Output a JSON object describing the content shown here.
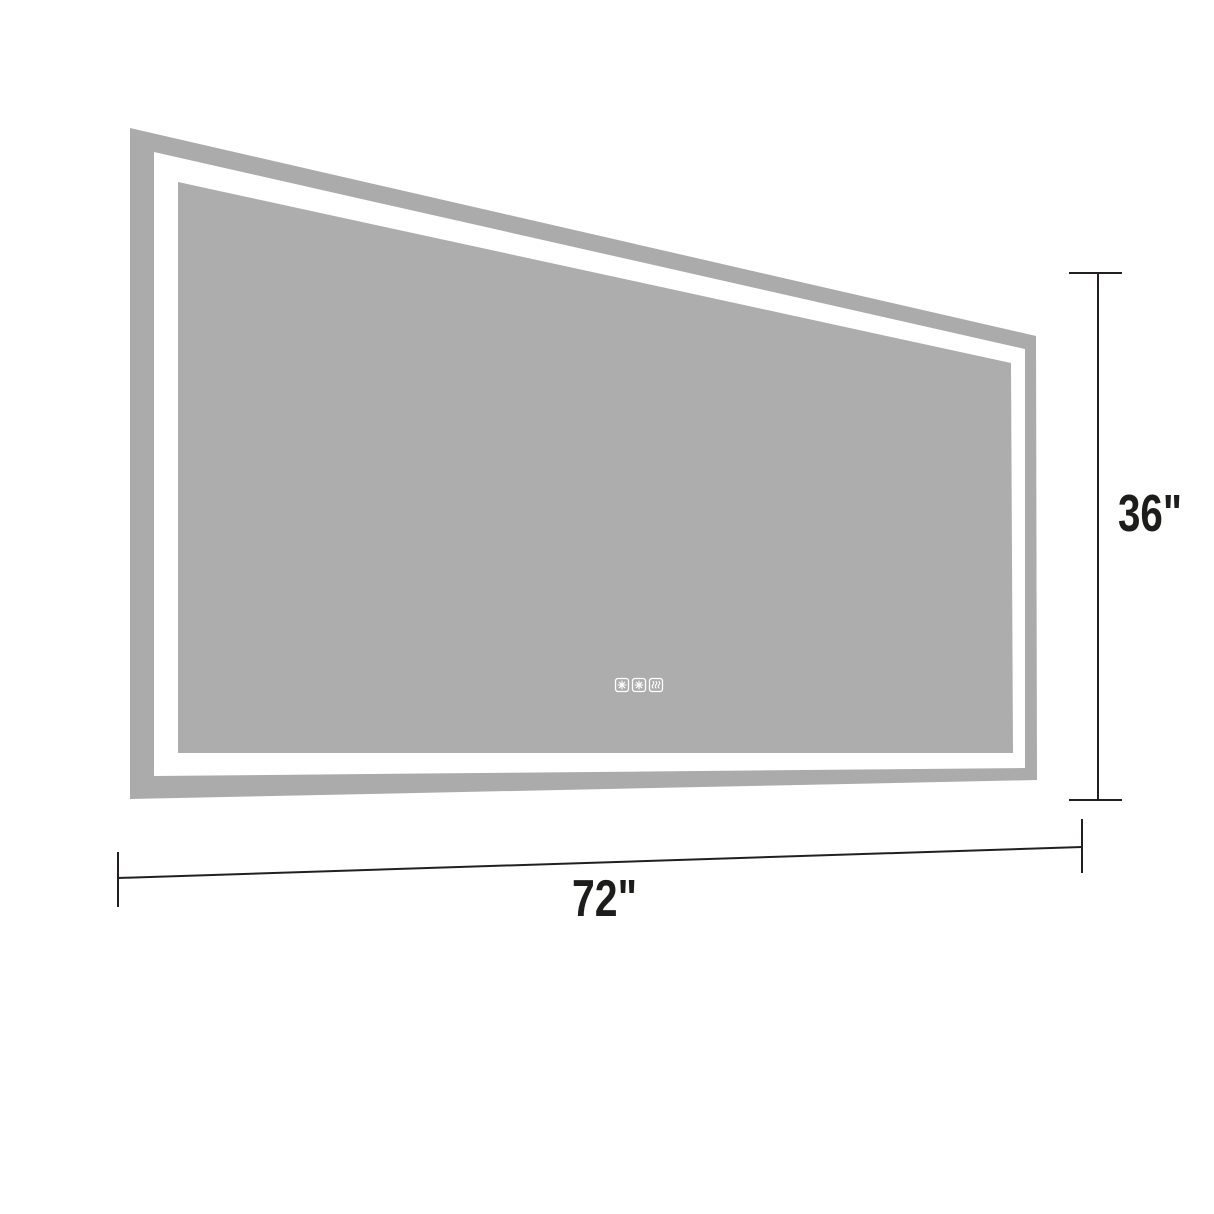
{
  "diagram": {
    "background_color": "#ffffff",
    "mirror": {
      "frame_color": "#ababab",
      "glass_color": "#adadad",
      "led_color": "#ffffff",
      "touch_buttons": [
        {
          "name": "snowflake-button-1",
          "icon": "snowflake-icon"
        },
        {
          "name": "snowflake-button-2",
          "icon": "snowflake-icon"
        },
        {
          "name": "defog-button",
          "icon": "defog-waves-icon"
        }
      ]
    },
    "dimensions": {
      "height_label": "36\"",
      "width_label": "72\"",
      "line_color": "#231f20",
      "label_color": "#1d1d1b"
    }
  }
}
